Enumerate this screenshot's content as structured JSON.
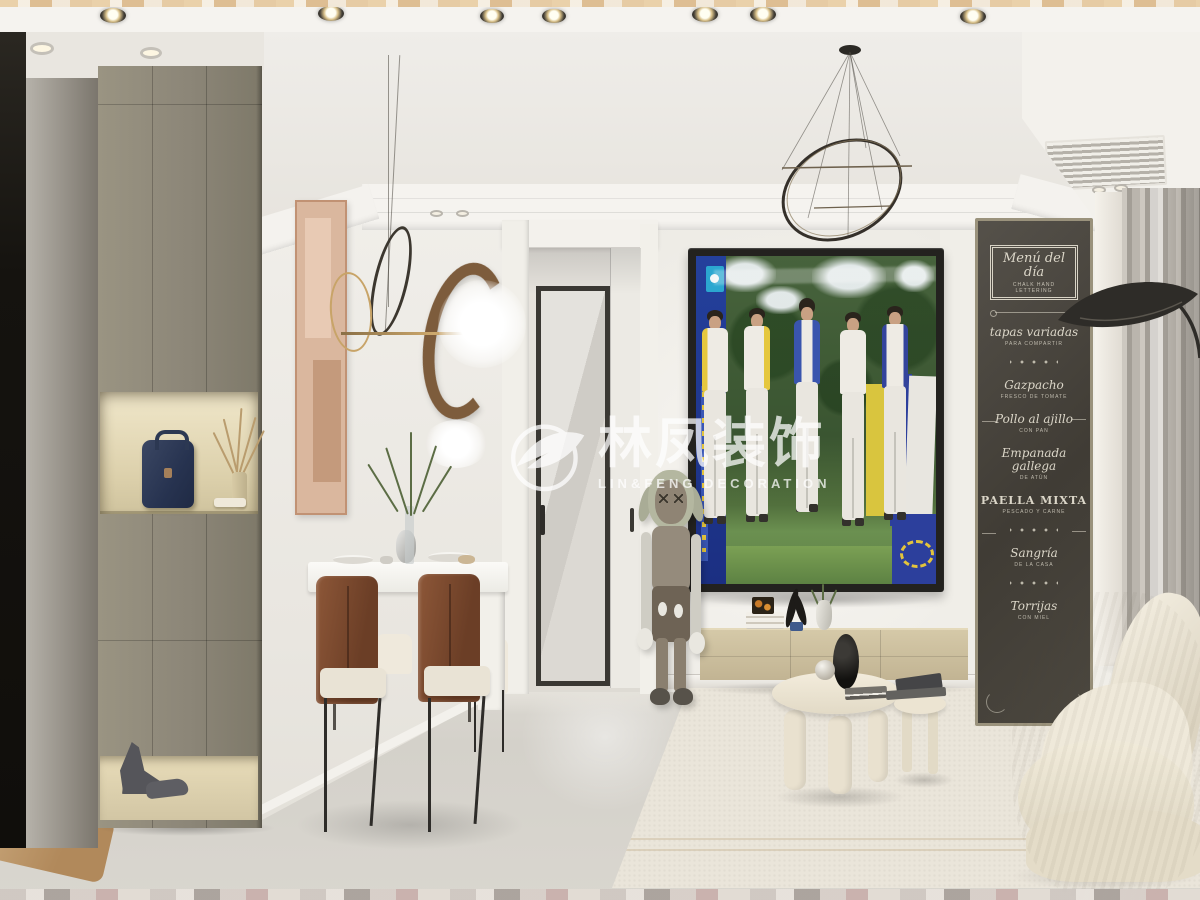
{
  "watermark": {
    "brand": "林凤装饰",
    "subtitle": "LIN&FENG DECORATION"
  },
  "chalkboard": {
    "header": {
      "title": "Menú del día",
      "subtitle": "CHALK HAND LETTERING"
    },
    "items": [
      {
        "name": "tapas variadas",
        "note": "PARA COMPARTIR"
      },
      {
        "name": "Gazpacho",
        "note": "FRESCO DE TOMATE"
      },
      {
        "name": "Pollo al ajillo",
        "note": "CON PAN"
      },
      {
        "name": "Empanada gallega",
        "note": "DE ATÚN"
      },
      {
        "name": "PAELLA MIXTA",
        "note": "PESCADO Y CARNE"
      },
      {
        "name": "Sangría",
        "note": "DE LA CASA"
      },
      {
        "name": "Torrijas",
        "note": "CON MIEL"
      }
    ]
  },
  "palette": {
    "wall": "#efede8",
    "ceiling": "#f5f3ef",
    "floor": "#d6d3cc",
    "rug": "#eae5da",
    "cabinet_taupe": "#8c8678",
    "niche_light": "#e8dcb9",
    "chalkboard": "#45413a",
    "chalk": "#dbd6c8",
    "tv_banner_blue": "#24409c",
    "tv_panel_yellow": "#d9c53e",
    "curtain_gray": "#b3aea6",
    "chair_brown": "#7a4a31",
    "stand_beige": "#cbbf9e",
    "sofa_cream": "#ece5d5",
    "ring_brown": "#7d5c3c",
    "bag_navy": "#2c3852"
  }
}
